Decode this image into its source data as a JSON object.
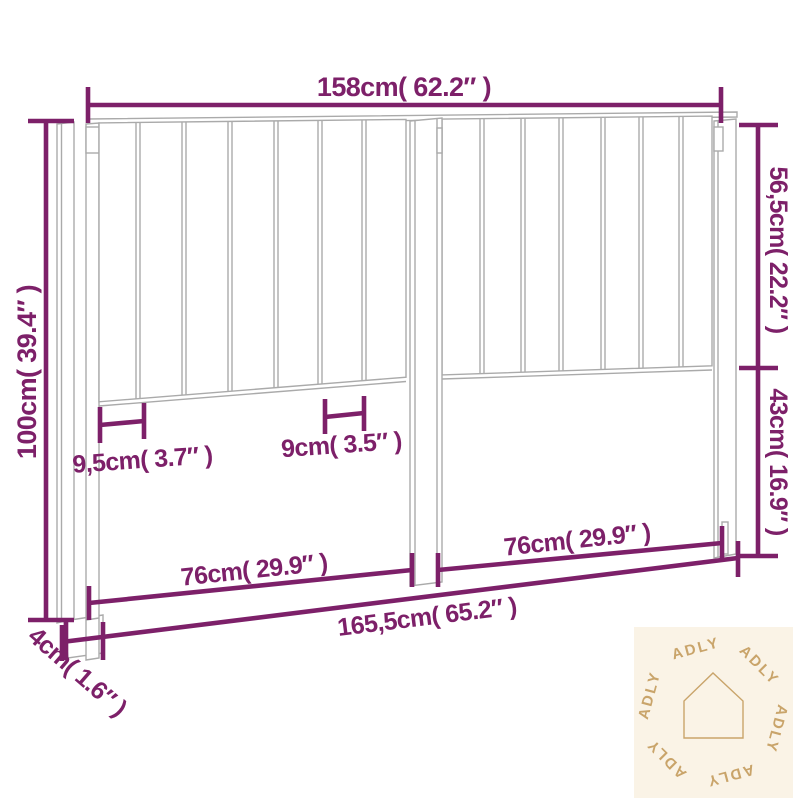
{
  "page": {
    "background_color": "#ffffff"
  },
  "diagram": {
    "subject": "headboard dimension drawing",
    "accent_color": "#7d2069",
    "outline_color": "#aaaaaa",
    "labels": {
      "top_width": "158cm( 62.2″ )",
      "left_height": "100cm( 39.4″ )",
      "right_upper_height": "56,5cm( 22.2″ )",
      "right_lower_height": "43cm( 16.9″ )",
      "slat_spacing_left": "9,5cm( 3.7″ )",
      "slat_spacing_right": "9cm( 3.5″ )",
      "bottom_left_width": "76cm( 29.9″ )",
      "bottom_right_width": "76cm( 29.9″ )",
      "total_width": "165,5cm( 65.2″ )",
      "leg_thickness": "4cm( 1.6″ )"
    }
  },
  "watermark": {
    "brand": "ADLY",
    "background_color": "#faf3e6",
    "color": "#c9a46a"
  }
}
